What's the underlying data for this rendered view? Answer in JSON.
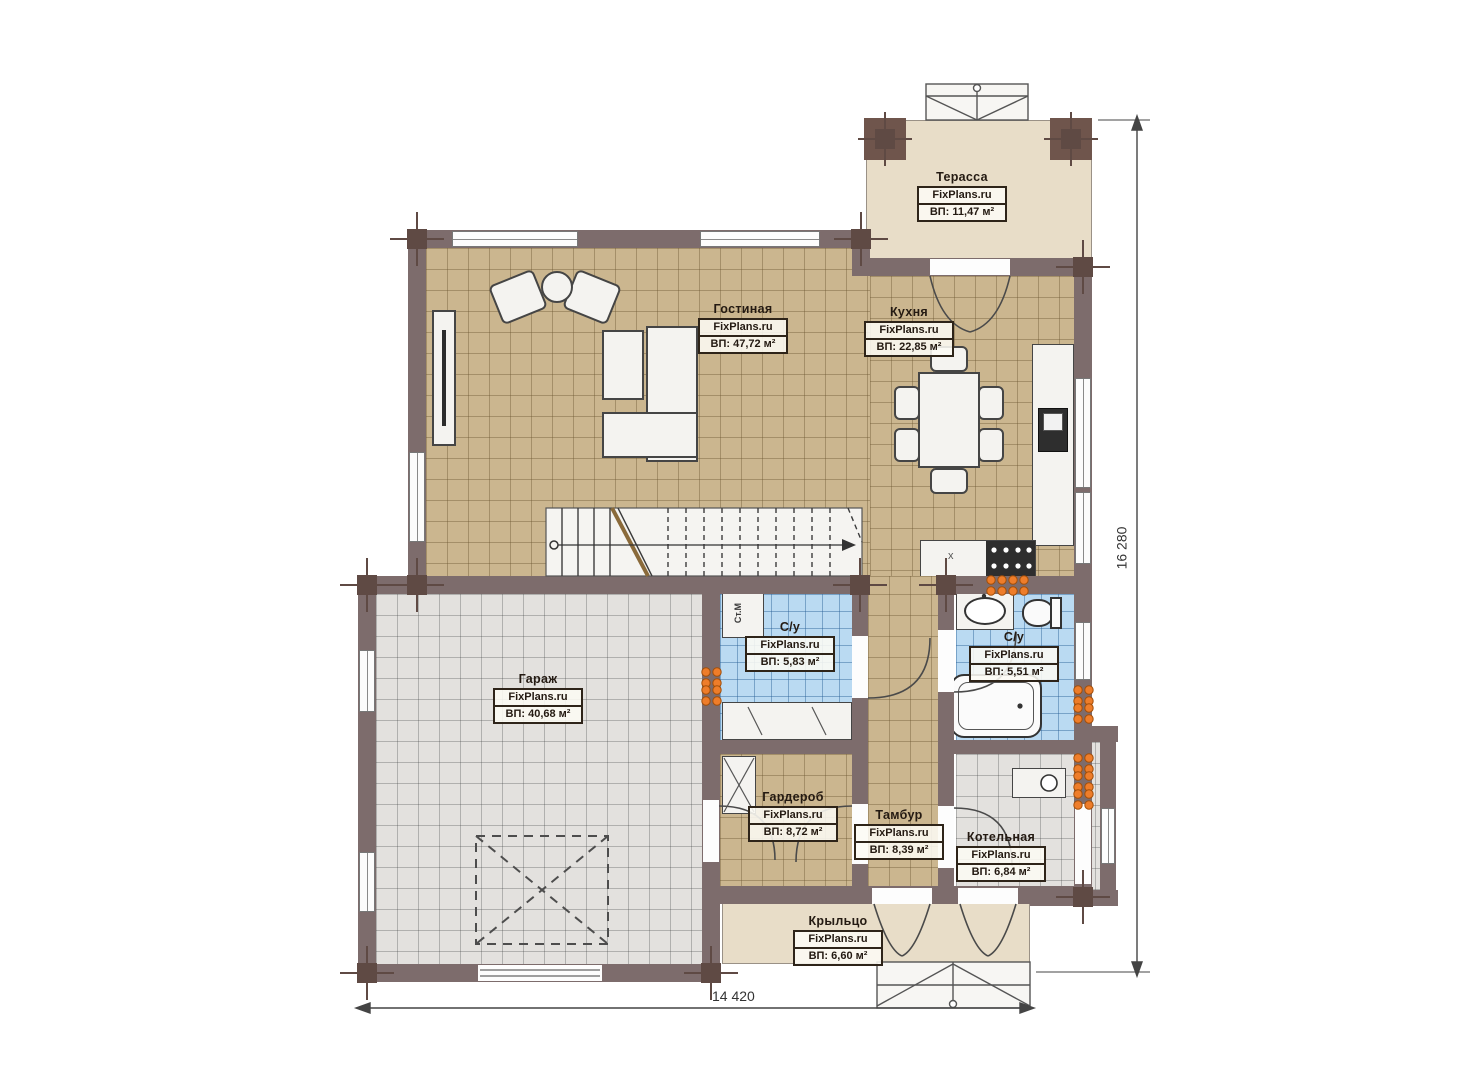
{
  "rooms": {
    "terrace": {
      "name": "Терасса",
      "watermark": "FixPlans.ru",
      "area": "ВП: 11,47 м²"
    },
    "living": {
      "name": "Гостиная",
      "watermark": "FixPlans.ru",
      "area": "ВП: 47,72 м²"
    },
    "kitchen": {
      "name": "Кухня",
      "watermark": "FixPlans.ru",
      "area": "ВП: 22,85 м²"
    },
    "garage": {
      "name": "Гараж",
      "watermark": "FixPlans.ru",
      "area": "ВП: 40,68 м²"
    },
    "bath1": {
      "name": "С/у",
      "watermark": "FixPlans.ru",
      "area": "ВП: 5,83 м²"
    },
    "bath2": {
      "name": "С/у",
      "watermark": "FixPlans.ru",
      "area": "ВП: 5,51 м²"
    },
    "wardrobe": {
      "name": "Гардероб",
      "watermark": "FixPlans.ru",
      "area": "ВП: 8,72 м²"
    },
    "vestibule": {
      "name": "Тамбур",
      "watermark": "FixPlans.ru",
      "area": "ВП: 8,39 м²"
    },
    "boiler": {
      "name": "Котельная",
      "watermark": "FixPlans.ru",
      "area": "ВП: 6,84 м²"
    },
    "porch": {
      "name": "Крыльцо",
      "watermark": "FixPlans.ru",
      "area": "ВП: 6,60 м²"
    }
  },
  "dims": {
    "vertical": "16 280",
    "horizontal": "14 420"
  },
  "fixtures": {
    "washing_machine": "Ст.М",
    "kitchen_unit_mark": "x"
  },
  "colors": {
    "wall": "#7d6c6c",
    "column": "#6f554c",
    "floor_living": "#cbb68f",
    "floor_service": "#e3e1de",
    "floor_bath": "#badaf2",
    "floor_outdoor": "#e8ddc8",
    "radiator": "#ee7d2a"
  }
}
